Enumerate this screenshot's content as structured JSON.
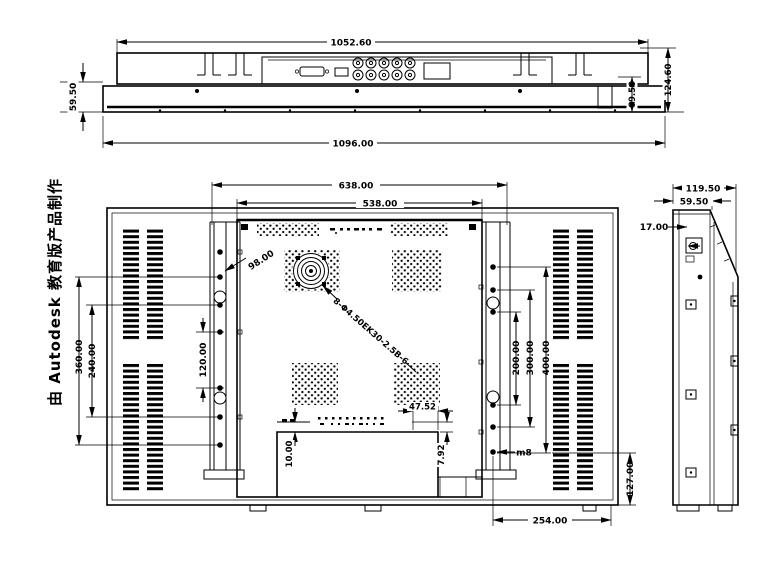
{
  "watermark": {
    "text": "由 Autodesk 教育版产品制作"
  },
  "colors": {
    "line": "#000000",
    "background": "#ffffff"
  },
  "top_view": {
    "dim_width_inner": "1052.60",
    "dim_width_outer": "1096.00",
    "dim_height_left": "59.50",
    "dim_height_right_inner": "69.50",
    "dim_height_right_outer": "124.60"
  },
  "front_view": {
    "dim_bracket_span": "638.00",
    "dim_panel_width": "538.00",
    "dim_left_outer": "360.00",
    "dim_left_inner": "240.00",
    "dim_bracket_holes": "120.00",
    "dim_right_inner": "200.00",
    "dim_right_mid": "300.00",
    "dim_right_outer": "400.00",
    "dim_hole_offset": "98.00",
    "dim_recess_width": "47.52",
    "dim_recess_edge": "7.92",
    "dim_strip_offset": "10.00",
    "dim_bottom_right_height": "127.00",
    "dim_bottom_width": "254.00",
    "label_bolt": "m8",
    "callout_holes": "8-Φ4.50EK30-2.5B-6"
  },
  "side_view": {
    "dim_depth_total": "119.50",
    "dim_depth_front": "59.50",
    "dim_bracket_offset": "17.00"
  }
}
